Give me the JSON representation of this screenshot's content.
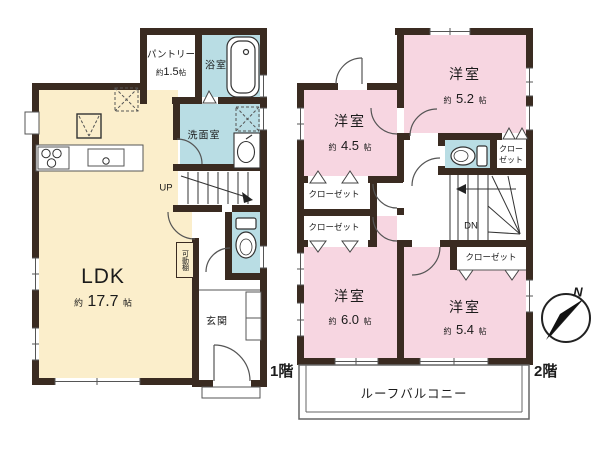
{
  "floor1": {
    "label": "1階",
    "ldk": {
      "name": "LDK",
      "size_prefix": "約",
      "size_value": "17.7",
      "size_unit": "帖"
    },
    "pantry": {
      "name": "パントリー",
      "size_prefix": "約",
      "size_value": "1.5",
      "size_unit": "帖"
    },
    "bathroom": "浴室",
    "washroom": "洗面室",
    "entrance": "玄関",
    "movable_shelf": "可動棚",
    "stairs_up": "UP"
  },
  "floor2": {
    "label": "2階",
    "rooms": {
      "nw": {
        "name": "洋室",
        "size_prefix": "約",
        "size_value": "4.5",
        "size_unit": "帖"
      },
      "ne": {
        "name": "洋室",
        "size_prefix": "約",
        "size_value": "5.2",
        "size_unit": "帖"
      },
      "sw": {
        "name": "洋室",
        "size_prefix": "約",
        "size_value": "6.0",
        "size_unit": "帖"
      },
      "se": {
        "name": "洋室",
        "size_prefix": "約",
        "size_value": "5.4",
        "size_unit": "帖"
      }
    },
    "closet_nw_upper": "クローゼット",
    "closet_nw_lower": "クローゼット",
    "closet_se": "クローゼット",
    "closet_ne_line1": "クロー",
    "closet_ne_line2": "ゼット",
    "stairs_down": "DN",
    "balcony": "ルーフバルコニー"
  },
  "compass_north": "N",
  "colors": {
    "wall": "#3a2b21",
    "ldk_fill": "#fbeecb",
    "bedroom_fill": "#f7d6e1",
    "wet_area_fill": "#b9dde4",
    "line": "#4a4a4a"
  }
}
